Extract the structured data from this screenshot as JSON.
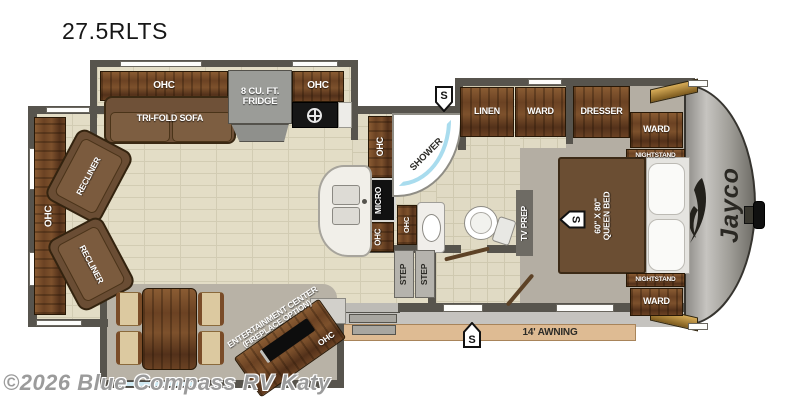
{
  "title": "27.5RLTS",
  "watermark": "©2026 Blue Compass RV Katy",
  "brand_logo": "Jayco",
  "awning_label": "14' AWNING",
  "speaker_symbol": "S",
  "colors": {
    "wall": "#57544d",
    "floor_tile": "#e3ddc6",
    "wood_cabinet": "#6b4223",
    "slide_floor": "#b8b2a6",
    "awning": "#debb93",
    "front_cap": "#9b9993",
    "shower_accent": "#a9dcee"
  },
  "living": {
    "ohc_rear": "OHC",
    "recliner_top": "RECLINER",
    "recliner_bottom": "RECLINER",
    "ohc_sofa": "OHC",
    "sofa": "TRI-FOLD SOFA",
    "fridge_line1": "8 CU. FT.",
    "fridge_line2": "FRIDGE",
    "ohc_stove": "OHC",
    "ent_line1": "ENTERTAINMENT CENTER",
    "ent_line2": "(FIREPLACE OPTION)",
    "ohc_ent": "OHC"
  },
  "kitchen": {
    "ohc_upper": "OHC",
    "micro": "MICRO",
    "ohc_lower": "OHC"
  },
  "bath": {
    "shower": "SHOWER",
    "ohc_vanity": "OHC",
    "linen": "LINEN",
    "ward": "WARD",
    "step1": "STEP",
    "step2": "STEP"
  },
  "bedroom": {
    "tv_prep": "TV PREP",
    "dresser": "DRESSER",
    "ward_top": "WARD",
    "nightstand_top": "NIGHTSTAND",
    "bed_line1": "60\" X 80\"",
    "bed_line2": "QUEEN BED",
    "nightstand_bottom": "NIGHTSTAND",
    "ward_bottom": "WARD"
  }
}
